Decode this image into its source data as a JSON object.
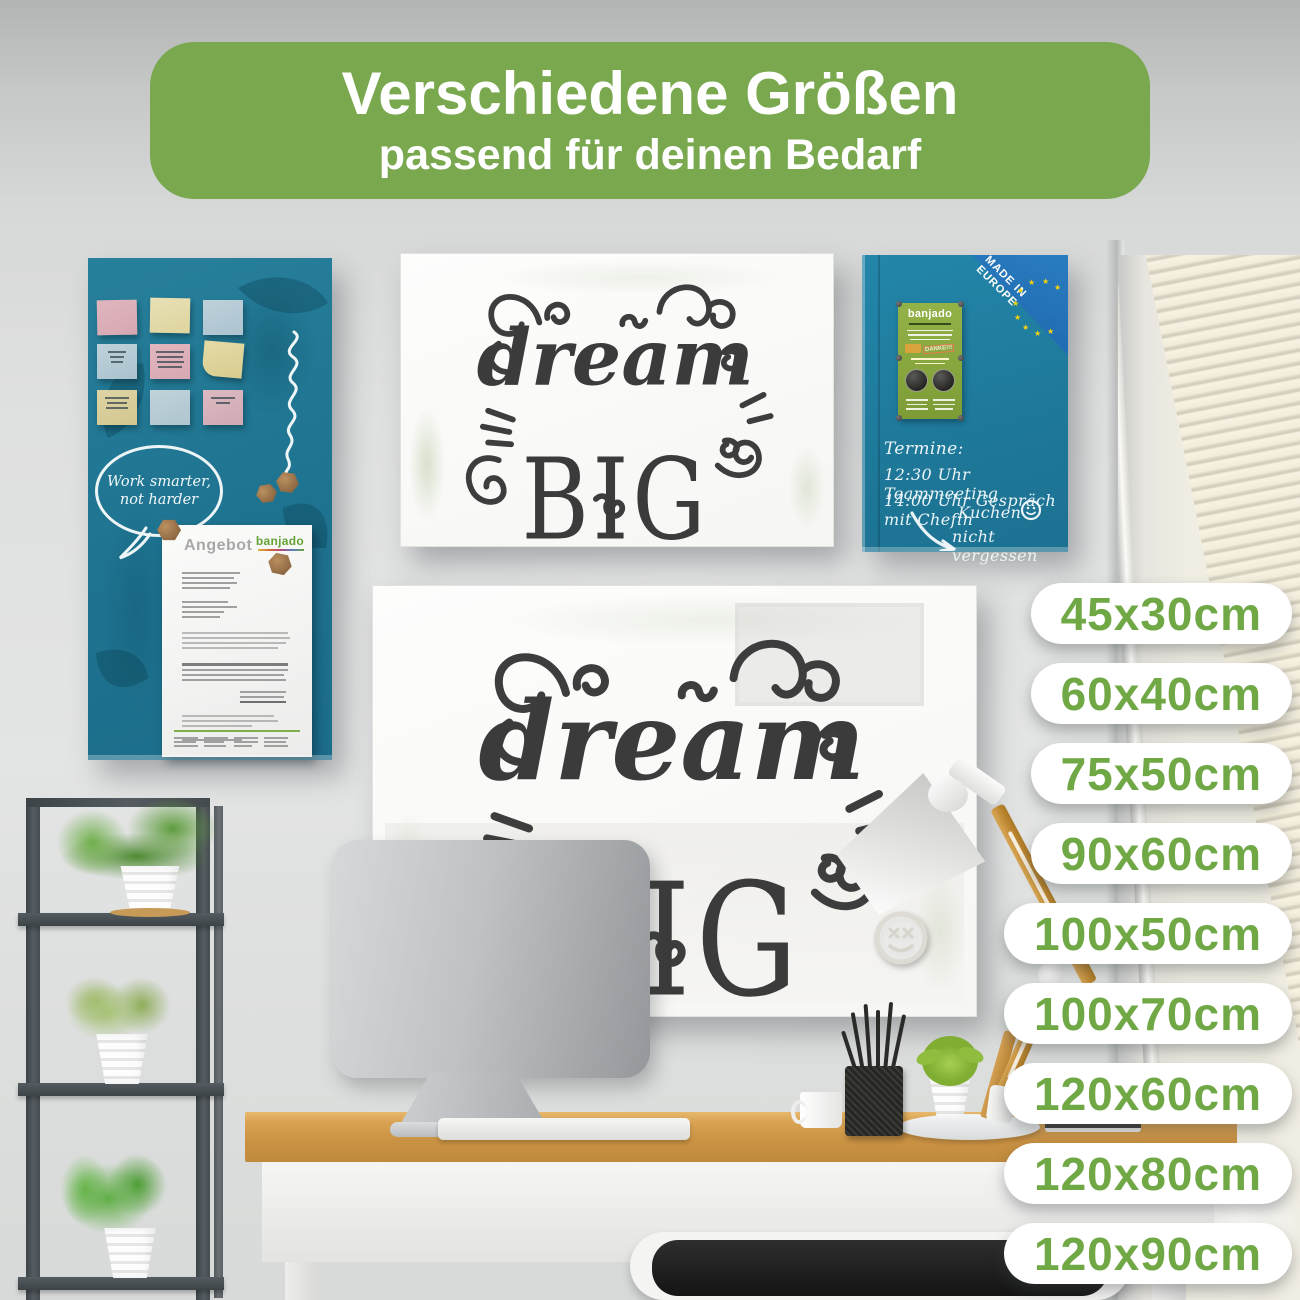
{
  "header": {
    "title": "Verschiedene Größen",
    "subtitle": "passend für deinen Bedarf"
  },
  "size_badges": [
    "45x30cm",
    "60x40cm",
    "75x50cm",
    "90x60cm",
    "100x50cm",
    "100x70cm",
    "120x60cm",
    "120x80cm",
    "120x90cm"
  ],
  "noteboard": {
    "bubble_line1": "Work smarter,",
    "bubble_line2": "not harder",
    "document": {
      "title": "Angebot",
      "brand": "banjado"
    }
  },
  "dream_board_small": {
    "script_word": "dream",
    "caps_word": "BIG"
  },
  "dream_board_large": {
    "script_word": "dream",
    "caps_word": "BIG"
  },
  "planner_board": {
    "made_in_line1": "MADE IN",
    "made_in_line2": "EUROPE",
    "flyer": {
      "brand": "banjado",
      "stamp": "DANKE!!!"
    },
    "handwriting": {
      "heading": "Termine:",
      "line1": "12:30 Uhr Teammeeting",
      "line2": "14:00 Uhr Gespräch mit Chefin",
      "cake_line1": "Kuchen",
      "cake_line2": "nicht vergessen"
    }
  },
  "colors": {
    "accent_green": "#79a84e",
    "badge_text_green": "#6fa844",
    "teal_board": "#1e7390",
    "teal_planner": "#1e7899",
    "eu_blue": "#1d66ad",
    "flyer_green": "#83a23c",
    "desk_wood": "#d09547"
  }
}
